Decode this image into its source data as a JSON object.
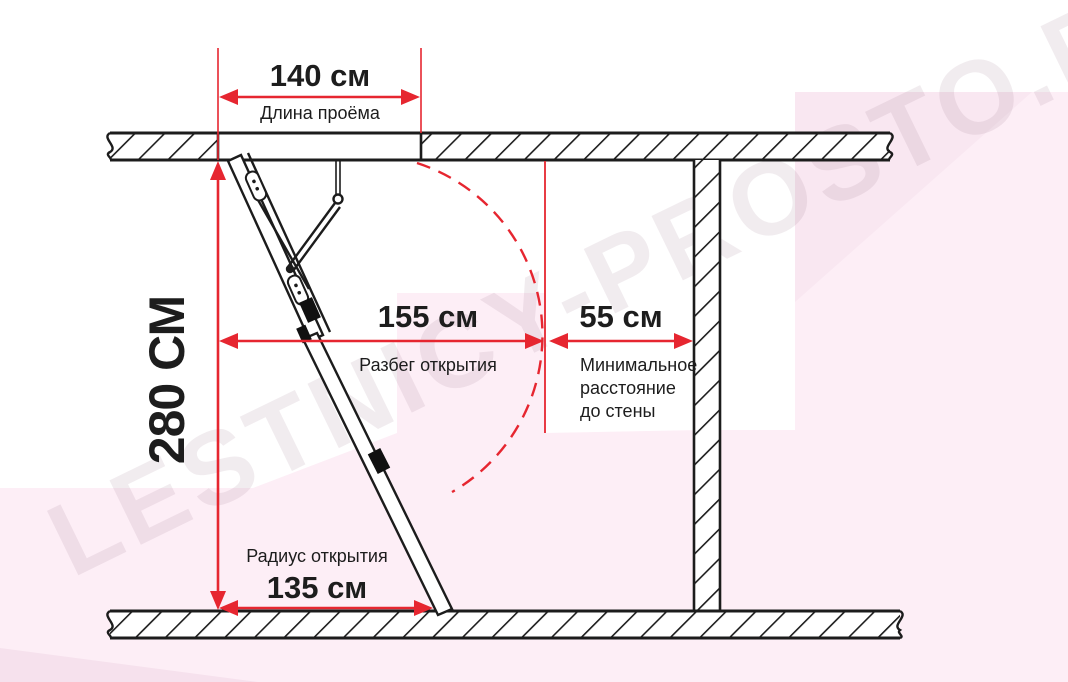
{
  "watermark": {
    "text": "LESTNICY-PROSTO.RU"
  },
  "colors": {
    "dimension_red": "#e62630",
    "line_black": "#1c1c1c",
    "bg_pink_light": "#fdeef6",
    "bg_pink_mid": "#f9e7f1",
    "bg_pink_dark": "#f6e1ed"
  },
  "dimensions": {
    "opening_length": {
      "value": "140 см",
      "label": "Длина проёма"
    },
    "ceiling_height": {
      "value": "280 СМ"
    },
    "opening_run": {
      "value": "155 см",
      "label": "Разбег открытия"
    },
    "wall_distance": {
      "value": "55 см",
      "label_lines": [
        "Минимальное",
        "расстояние",
        "до стены"
      ]
    },
    "opening_radius": {
      "value": "135 см",
      "label": "Радиус открытия"
    }
  }
}
